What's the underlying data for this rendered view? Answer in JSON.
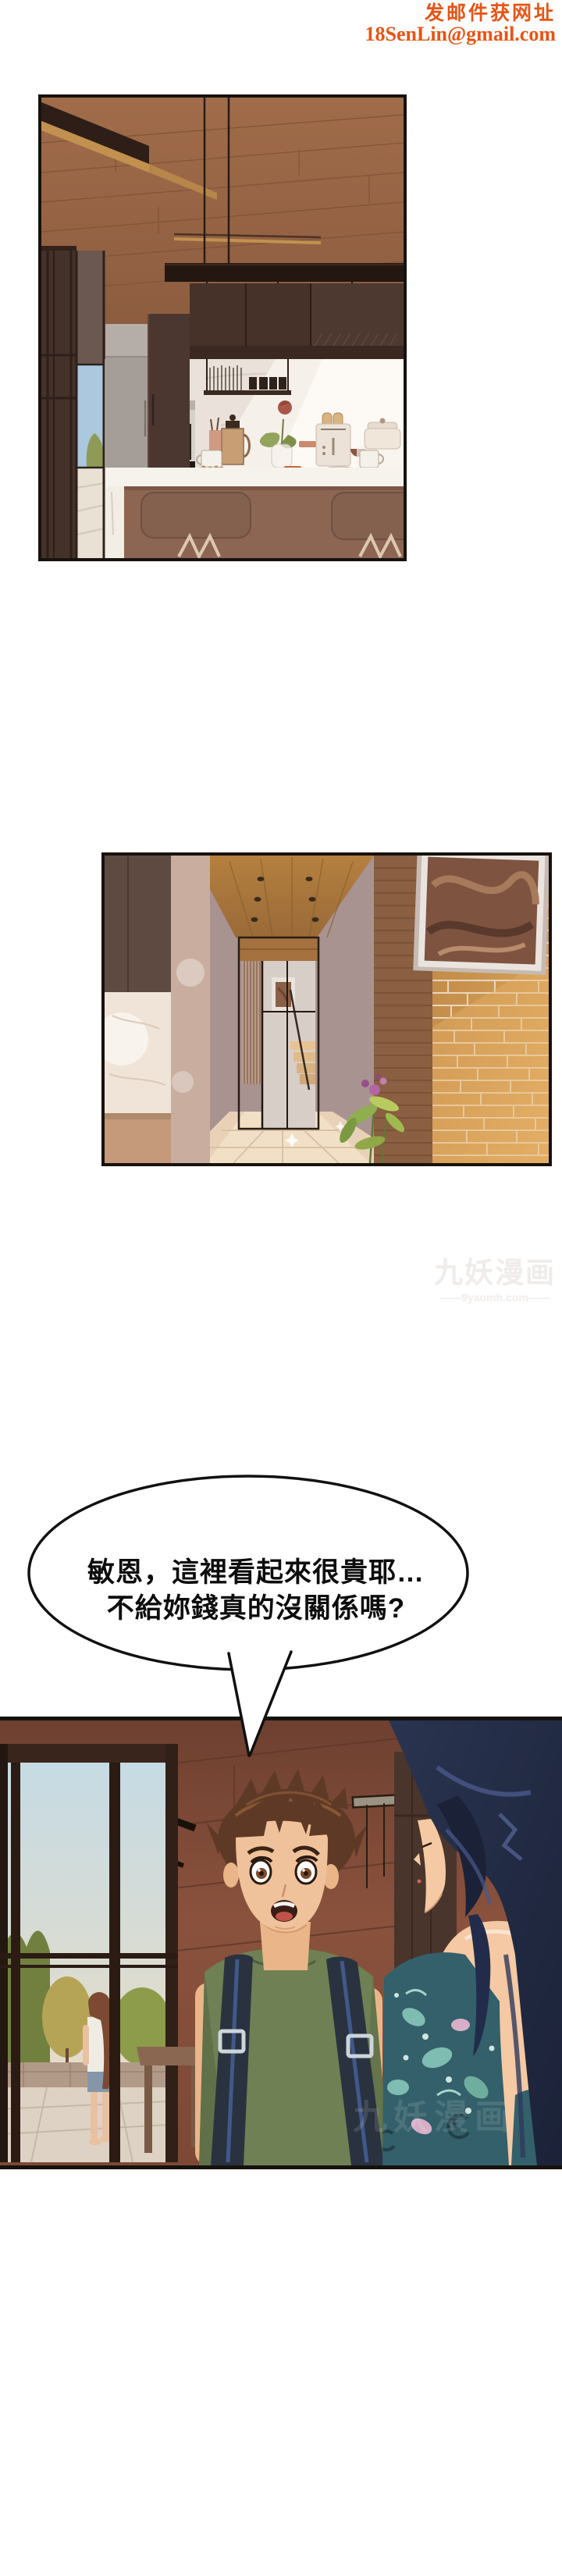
{
  "page": {
    "background": "#ffffff"
  },
  "email_watermark": {
    "line1": "发邮件获网址",
    "line2": "18SenLin@gmail.com",
    "color": "#e85414"
  },
  "site_watermark": {
    "title": "九妖漫画",
    "subtitle": "——9yaomh.com——",
    "color": "#efecea"
  },
  "speech_bubble": {
    "line1": "敏恩，這裡看起來很貴耶…",
    "line2": "不給妳錢真的沒關係嗎?",
    "fill": "#ffffff",
    "stroke": "#111111",
    "text_color": "#0d0d0d"
  },
  "panels": [
    {
      "id": "kitchen",
      "name": "kitchen-interior"
    },
    {
      "id": "hallway",
      "name": "hallway-interior"
    },
    {
      "id": "scene",
      "name": "couple-conversation"
    }
  ]
}
